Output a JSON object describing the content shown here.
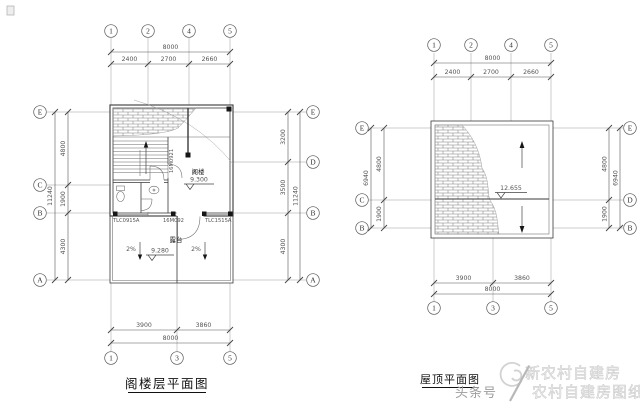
{
  "left_plan": {
    "caption": "阁楼层平面图",
    "grid_top": [
      "1",
      "2",
      "4",
      "5"
    ],
    "grid_bottom": [
      "1",
      "3",
      "5"
    ],
    "grid_left": [
      "E",
      "C",
      "B",
      "A"
    ],
    "grid_right": [
      "E",
      "D",
      "B",
      "A"
    ],
    "dims": {
      "top_total": "8000",
      "top_segments": [
        "2400",
        "2700",
        "2660"
      ],
      "bottom_total": "8000",
      "bottom_segments": [
        "3900",
        "3860"
      ],
      "left_total": "11240",
      "left_segments": [
        "4800",
        "1900",
        "4300"
      ],
      "right_total": "11240",
      "right_segments": [
        "3200",
        "3500",
        "4300"
      ]
    },
    "labels": {
      "room": "阁楼",
      "room_level": "9.300",
      "terrace": "露台",
      "terrace_level": "9.280",
      "slope_left": "2%",
      "slope_right": "2%",
      "stair_door": "16M0921",
      "window_left": "TLC0915A",
      "door_bottom": "16M092",
      "window_right": "TLC1515A"
    }
  },
  "right_plan": {
    "caption": "屋顶平面图",
    "grid_top": [
      "1",
      "2",
      "4",
      "5"
    ],
    "grid_bottom": [
      "1",
      "3",
      "5"
    ],
    "grid_left": [
      "E",
      "C",
      "B"
    ],
    "grid_right": [
      "E",
      "D",
      "B"
    ],
    "dims": {
      "top_total": "8000",
      "top_segments": [
        "2400",
        "2700",
        "2660"
      ],
      "bottom_total": "8000",
      "bottom_segments": [
        "3900",
        "3860"
      ],
      "left_total": "6940",
      "left_segments": [
        "4800",
        "1900"
      ],
      "right_total": "6940",
      "right_segments": [
        "4800",
        "1900"
      ]
    },
    "labels": {
      "ridge_level": "12.655"
    }
  },
  "watermark": {
    "brand": "新农村自建房",
    "source": "头条号",
    "divider": "/",
    "series": "农村自建房图纸"
  }
}
